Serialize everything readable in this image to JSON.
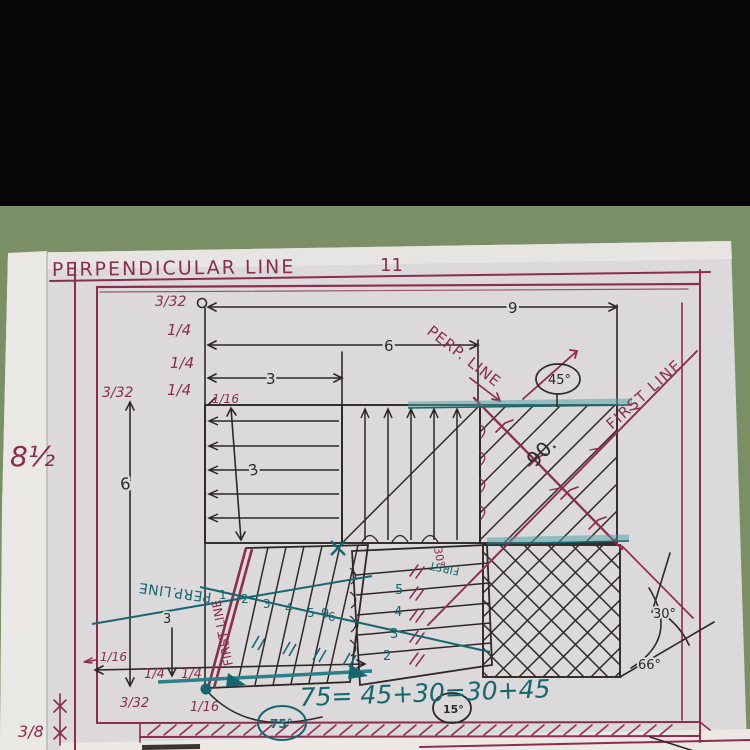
{
  "photo": {
    "background_top_color": "#060606",
    "desk_color": "#7b8f67",
    "paper_color": "#dbd9da",
    "ink_magenta": "#8c2d4f",
    "ink_black": "#2e2826",
    "ink_teal": "#17666f",
    "teal_highlight": "#49a0a4"
  },
  "header": {
    "title": "PERPENDICULAR LINE",
    "page_number": "11"
  },
  "margins": {
    "sheet_height": "8½",
    "bottom_left_fraction": "3/8"
  },
  "top_dims": {
    "offset_1": "3/32",
    "offset_2": "1/4",
    "offset_3": "1/4",
    "offset_4": "1/4",
    "left_fraction": "3/32",
    "inset": "1/16",
    "width_9": "9",
    "width_6": "6",
    "width_3": "3"
  },
  "side_dims": {
    "height_6": "6",
    "height_3": "3"
  },
  "bottom_dims": {
    "arrow_sixteenth": "1/16",
    "quarter_a": "1/4",
    "quarter_b": "1/4",
    "fraction_332": "3/32",
    "sixteenth": "1/16",
    "height_3": "3"
  },
  "line_labels": {
    "perp_top": "PERP. LINE",
    "first_top": "FIRST LINE",
    "perp_bottom": "PERP.LINE",
    "first_bottom": "FIRST LINE",
    "first_small": "FIRST",
    "angle_30_small": "30°"
  },
  "angles": {
    "deg45": "45°",
    "deg90": "90.",
    "deg30": "30°",
    "deg66": "66°",
    "deg75": "75°",
    "deg15": "15°"
  },
  "equation": {
    "text": "75= 45+30=30+45"
  },
  "ticks": {
    "d1": "1",
    "d2": "2",
    "d3": "3",
    "d4": "4",
    "d5": "5",
    "d6": "6",
    "c5": "5",
    "c4": "4",
    "c3": "3",
    "c2": "2",
    "n9": "9"
  }
}
